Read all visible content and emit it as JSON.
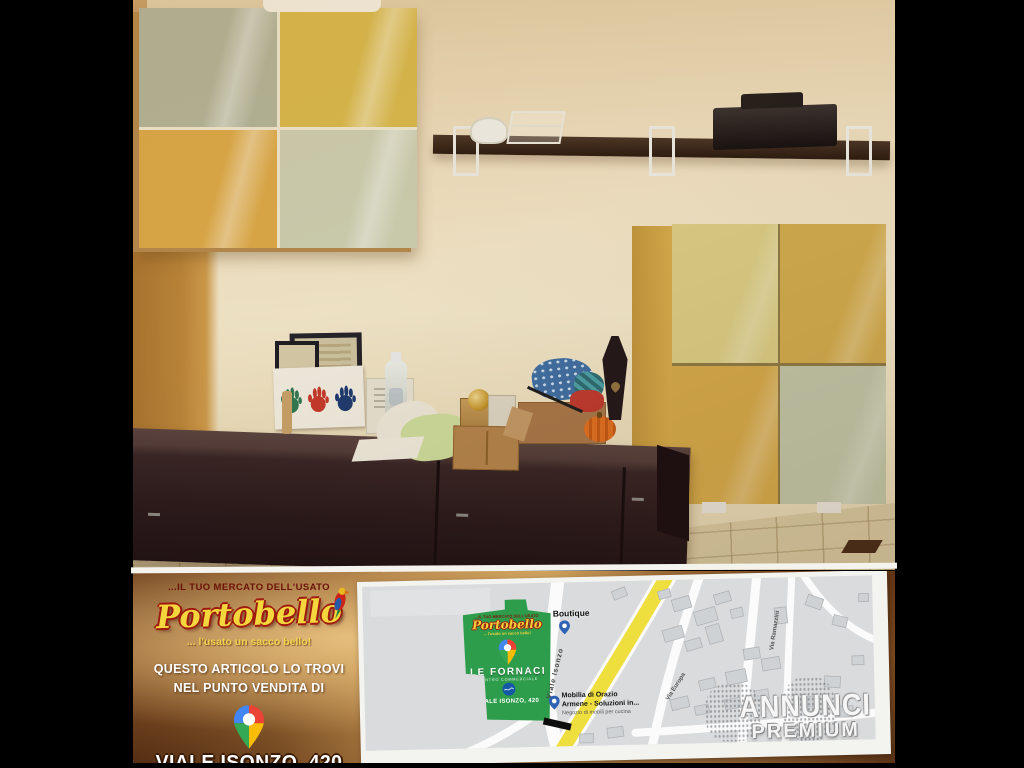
{
  "banner": {
    "promo": {
      "tagline_top": "...IL TUO MERCATO DELL'USATO",
      "brand": "Portobello",
      "tagline_bottom": "... l'usato un sacco bello!",
      "find_line1": "QUESTO ARTICOLO LO TROVI",
      "find_line2": "NEL PUNTO VENDITA DI",
      "address_line1": "VIALE ISONZO, 420",
      "address_line2": "CC LE FORNACI"
    },
    "map": {
      "store": {
        "tagline_top": "...IL TUO MERCATO DELL'USATO",
        "brand": "Portobello",
        "tagline_bottom": "... l'usato un sacco bello!",
        "name": "LE FORNACI",
        "subtitle": "CENTRO COMMERCIALE",
        "address": "VIALE ISONZO, 420"
      },
      "pois": {
        "boutique": "Boutique",
        "mobilia_line1": "Mobilia di Orazio",
        "mobilia_line2": "Armene - Soluzioni in...",
        "mobilia_line3": "Negozio di mobili per cucina"
      },
      "streets": {
        "main": "Viale Isonzo",
        "right_near": "Via Europa",
        "right_far": "Via Ramazzini"
      },
      "watermark": {
        "line1": "ANNUNCI",
        "line2": "PREMIUM"
      }
    },
    "icons": {
      "google_maps_pin": "multicolor-teardrop",
      "poi_pin": "blue-teardrop",
      "parrot": "red-parrot",
      "store_emblem": "blue-circle-logo"
    }
  },
  "photo": {
    "colors": {
      "wall": "#efe3c4",
      "left_wall": "#b8823a",
      "wall_cabinet_panels": [
        "#b2b59a",
        "#d9ba4e",
        "#dcaa48",
        "#cccfb2"
      ],
      "tall_cabinet_panels": [
        "#dacd85",
        "#d2ac4e",
        "#d5aa4b",
        "#c2c6a8"
      ],
      "shelf": "#3a2a1b",
      "bench": "#2c1b1e",
      "floor": "#d6c79c",
      "handprints": [
        "#2f7a52",
        "#c6392b",
        "#1c3a70"
      ],
      "pumpkin": "#d86820",
      "accent_green": "#2e9d4b",
      "road_yellow": "#efdf3e"
    }
  }
}
